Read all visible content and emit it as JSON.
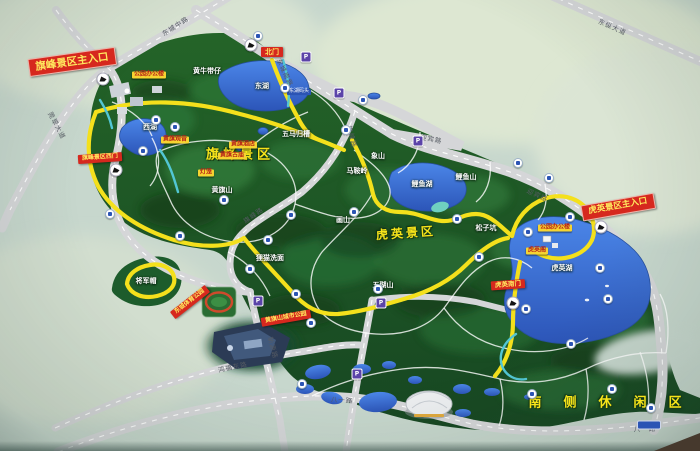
{
  "palette": {
    "board": "#c7d7cd",
    "park_green": "#1e5a2c",
    "route_yellow": "#f4e01c",
    "road_grey": "#d5d6d8",
    "lake_blue": "#3a6fd0",
    "gate_red": "#d6281e",
    "poi_yellow": "#f6d431"
  },
  "region_titles": [
    {
      "text": "旗峰景区",
      "x": 240,
      "y": 156,
      "size": 13,
      "ls": 4,
      "rot": 0
    },
    {
      "text": "虎英景区",
      "x": 406,
      "y": 234,
      "size": 12,
      "ls": 3,
      "rot": -4
    },
    {
      "text": "南侧休闲区",
      "x": 616,
      "y": 404,
      "size": 13,
      "ls": 22,
      "rot": 0
    }
  ],
  "place_labels": [
    {
      "text": "黄牛带仔",
      "x": 207,
      "y": 71
    },
    {
      "text": "东湖",
      "x": 262,
      "y": 86
    },
    {
      "text": "五马归槽",
      "x": 296,
      "y": 134
    },
    {
      "text": "象山",
      "x": 378,
      "y": 156
    },
    {
      "text": "马鞍岭",
      "x": 357,
      "y": 171
    },
    {
      "text": "鲤鱼山",
      "x": 466,
      "y": 177
    },
    {
      "text": "鲤鱼湖",
      "x": 422,
      "y": 184
    },
    {
      "text": "画山",
      "x": 343,
      "y": 220
    },
    {
      "text": "黄旗山",
      "x": 222,
      "y": 190
    },
    {
      "text": "西湖",
      "x": 150,
      "y": 127
    },
    {
      "text": "狸猫洗面",
      "x": 270,
      "y": 258
    },
    {
      "text": "五瑚山",
      "x": 383,
      "y": 285
    },
    {
      "text": "松子坑",
      "x": 486,
      "y": 228
    },
    {
      "text": "将军帽",
      "x": 146,
      "y": 281
    },
    {
      "text": "虎英湖",
      "x": 562,
      "y": 268
    }
  ],
  "gate_labels": [
    {
      "text": "旗峰景区主入口",
      "x": 72,
      "y": 62,
      "rot": -8,
      "big": true,
      "size": 10.5
    },
    {
      "text": "北门",
      "x": 272,
      "y": 52,
      "rot": 0,
      "big": false,
      "size": 7
    },
    {
      "text": "旗峰景区西门",
      "x": 100,
      "y": 158,
      "rot": -4,
      "big": false,
      "size": 6
    },
    {
      "text": "东城体育公园",
      "x": 190,
      "y": 302,
      "rot": -38,
      "big": false,
      "size": 6
    },
    {
      "text": "黄旗山城市公园",
      "x": 286,
      "y": 318,
      "rot": -10,
      "big": false,
      "size": 6
    },
    {
      "text": "虎英景区主入口",
      "x": 618,
      "y": 207,
      "rot": -10,
      "big": true,
      "size": 8.5
    },
    {
      "text": "虎英南门",
      "x": 508,
      "y": 285,
      "rot": -4,
      "big": false,
      "size": 6.5
    }
  ],
  "poi_labels": [
    {
      "text": "公园办公楼",
      "x": 149,
      "y": 75
    },
    {
      "text": "黄旗酒店",
      "x": 243,
      "y": 145
    },
    {
      "text": "黄旗观音",
      "x": 175,
      "y": 140
    },
    {
      "text": "黄旗古庙",
      "x": 232,
      "y": 156
    },
    {
      "text": "灯笼",
      "x": 206,
      "y": 173
    },
    {
      "text": "公园办公楼",
      "x": 555,
      "y": 228
    },
    {
      "text": "虎英阁",
      "x": 537,
      "y": 251
    }
  ],
  "blue_labels": [
    {
      "text": "东湖码头",
      "x": 299,
      "y": 92
    }
  ],
  "road_labels": [
    {
      "text": "东城中路",
      "x": 176,
      "y": 27,
      "rot": -33
    },
    {
      "text": "莞翠大道",
      "x": 56,
      "y": 126,
      "rot": 62
    },
    {
      "text": "东纵大道",
      "x": 612,
      "y": 28,
      "rot": 24
    },
    {
      "text": "东城南路",
      "x": 284,
      "y": 73,
      "rot": 65
    },
    {
      "text": "迎宾路",
      "x": 431,
      "y": 140,
      "rot": 12
    },
    {
      "text": "迎宾路",
      "x": 537,
      "y": 196,
      "rot": 25
    },
    {
      "text": "旗峰路",
      "x": 351,
      "y": 137,
      "rot": 75
    },
    {
      "text": "旗峰路",
      "x": 254,
      "y": 216,
      "rot": -35
    },
    {
      "text": "新源路",
      "x": 272,
      "y": 348,
      "rot": 75
    },
    {
      "text": "鸿福东路",
      "x": 233,
      "y": 368,
      "rot": -12
    },
    {
      "text": "八一路",
      "x": 342,
      "y": 401,
      "rot": 4
    },
    {
      "text": "八一路",
      "x": 645,
      "y": 430,
      "rot": -2
    }
  ],
  "icons": {
    "parking_glyph": "P",
    "items": [
      {
        "t": "gate",
        "x": 103,
        "y": 79
      },
      {
        "t": "gate",
        "x": 251,
        "y": 45
      },
      {
        "t": "gate",
        "x": 116,
        "y": 170
      },
      {
        "t": "gate",
        "x": 601,
        "y": 227
      },
      {
        "t": "gate",
        "x": 513,
        "y": 303
      },
      {
        "t": "parking",
        "x": 306,
        "y": 57
      },
      {
        "t": "parking",
        "x": 339,
        "y": 93
      },
      {
        "t": "parking",
        "x": 418,
        "y": 141
      },
      {
        "t": "parking",
        "x": 258,
        "y": 301
      },
      {
        "t": "parking",
        "x": 357,
        "y": 374
      },
      {
        "t": "parking",
        "x": 381,
        "y": 303
      },
      {
        "t": "dot",
        "x": 258,
        "y": 36
      },
      {
        "t": "dot",
        "x": 285,
        "y": 88
      },
      {
        "t": "dot",
        "x": 363,
        "y": 100
      },
      {
        "t": "dot",
        "x": 518,
        "y": 163
      },
      {
        "t": "dot",
        "x": 549,
        "y": 178
      },
      {
        "t": "dot",
        "x": 457,
        "y": 219
      },
      {
        "t": "dot",
        "x": 354,
        "y": 212
      },
      {
        "t": "dot",
        "x": 291,
        "y": 215
      },
      {
        "t": "dot",
        "x": 268,
        "y": 240
      },
      {
        "t": "dot",
        "x": 224,
        "y": 200
      },
      {
        "t": "dot",
        "x": 156,
        "y": 120
      },
      {
        "t": "dot",
        "x": 143,
        "y": 151
      },
      {
        "t": "dot",
        "x": 175,
        "y": 127
      },
      {
        "t": "dot",
        "x": 110,
        "y": 214
      },
      {
        "t": "dot",
        "x": 180,
        "y": 236
      },
      {
        "t": "dot",
        "x": 250,
        "y": 269
      },
      {
        "t": "dot",
        "x": 296,
        "y": 294
      },
      {
        "t": "dot",
        "x": 311,
        "y": 323
      },
      {
        "t": "dot",
        "x": 378,
        "y": 289
      },
      {
        "t": "dot",
        "x": 302,
        "y": 384
      },
      {
        "t": "dot",
        "x": 526,
        "y": 309
      },
      {
        "t": "dot",
        "x": 571,
        "y": 344
      },
      {
        "t": "dot",
        "x": 612,
        "y": 389
      },
      {
        "t": "dot",
        "x": 651,
        "y": 408
      },
      {
        "t": "dot",
        "x": 532,
        "y": 394
      },
      {
        "t": "dot",
        "x": 608,
        "y": 299
      },
      {
        "t": "dot",
        "x": 570,
        "y": 217
      },
      {
        "t": "dot",
        "x": 528,
        "y": 232
      },
      {
        "t": "dot",
        "x": 600,
        "y": 268
      },
      {
        "t": "dot",
        "x": 479,
        "y": 257
      },
      {
        "t": "dot",
        "x": 346,
        "y": 130
      },
      {
        "t": "pill",
        "x": 649,
        "y": 425
      }
    ]
  }
}
